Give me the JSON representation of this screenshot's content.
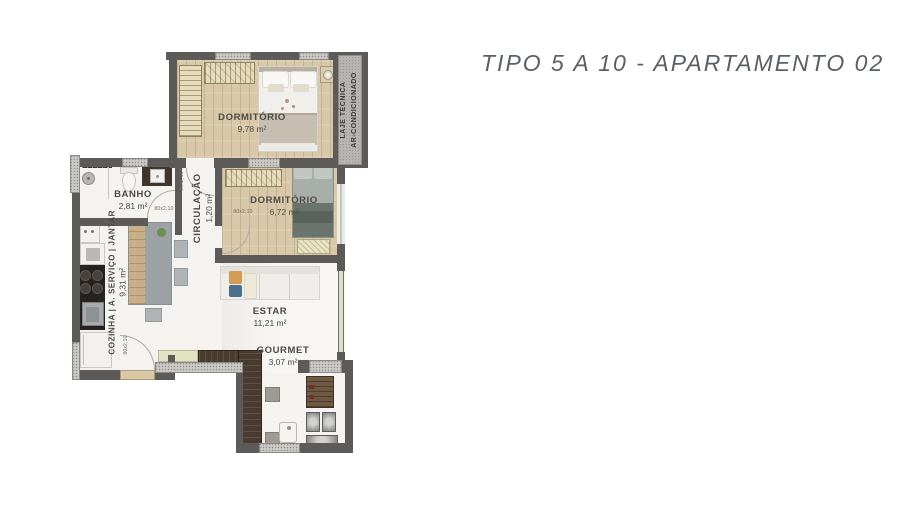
{
  "title": "TIPO 5 A 10 - APARTAMENTO 02",
  "plan": {
    "rooms": {
      "dormitorio_1": {
        "name": "DORMITÓRIO",
        "area": "9,78 m²"
      },
      "dormitorio_2": {
        "name": "DORMITÓRIO",
        "area": "6,72 m²"
      },
      "banho": {
        "name": "BANHO",
        "area": "2,81 m²"
      },
      "circulacao": {
        "name": "CIRCULAÇÃO",
        "area": "1,20 m²"
      },
      "cozinha": {
        "name": "COZINHA | A. SERVIÇO | JANTAR",
        "area": "9,31 m²"
      },
      "estar": {
        "name": "ESTAR",
        "area": "11,21 m²"
      },
      "gourmet": {
        "name": "GOURMET",
        "area": "3,07 m²"
      },
      "laje_tecnica": {
        "line1": "LAJE TÉCNICA",
        "line2": "AR-CONDICIONADO"
      }
    },
    "door_labels": {
      "standard": "80x2,10",
      "entry": "90x2,10"
    }
  },
  "colors": {
    "wall": "#5c5b59",
    "wood_floor": "#d9c7a9",
    "hatch": "#cbcac6",
    "title_text": "#5b6065",
    "glass": "#d9dfc9"
  }
}
